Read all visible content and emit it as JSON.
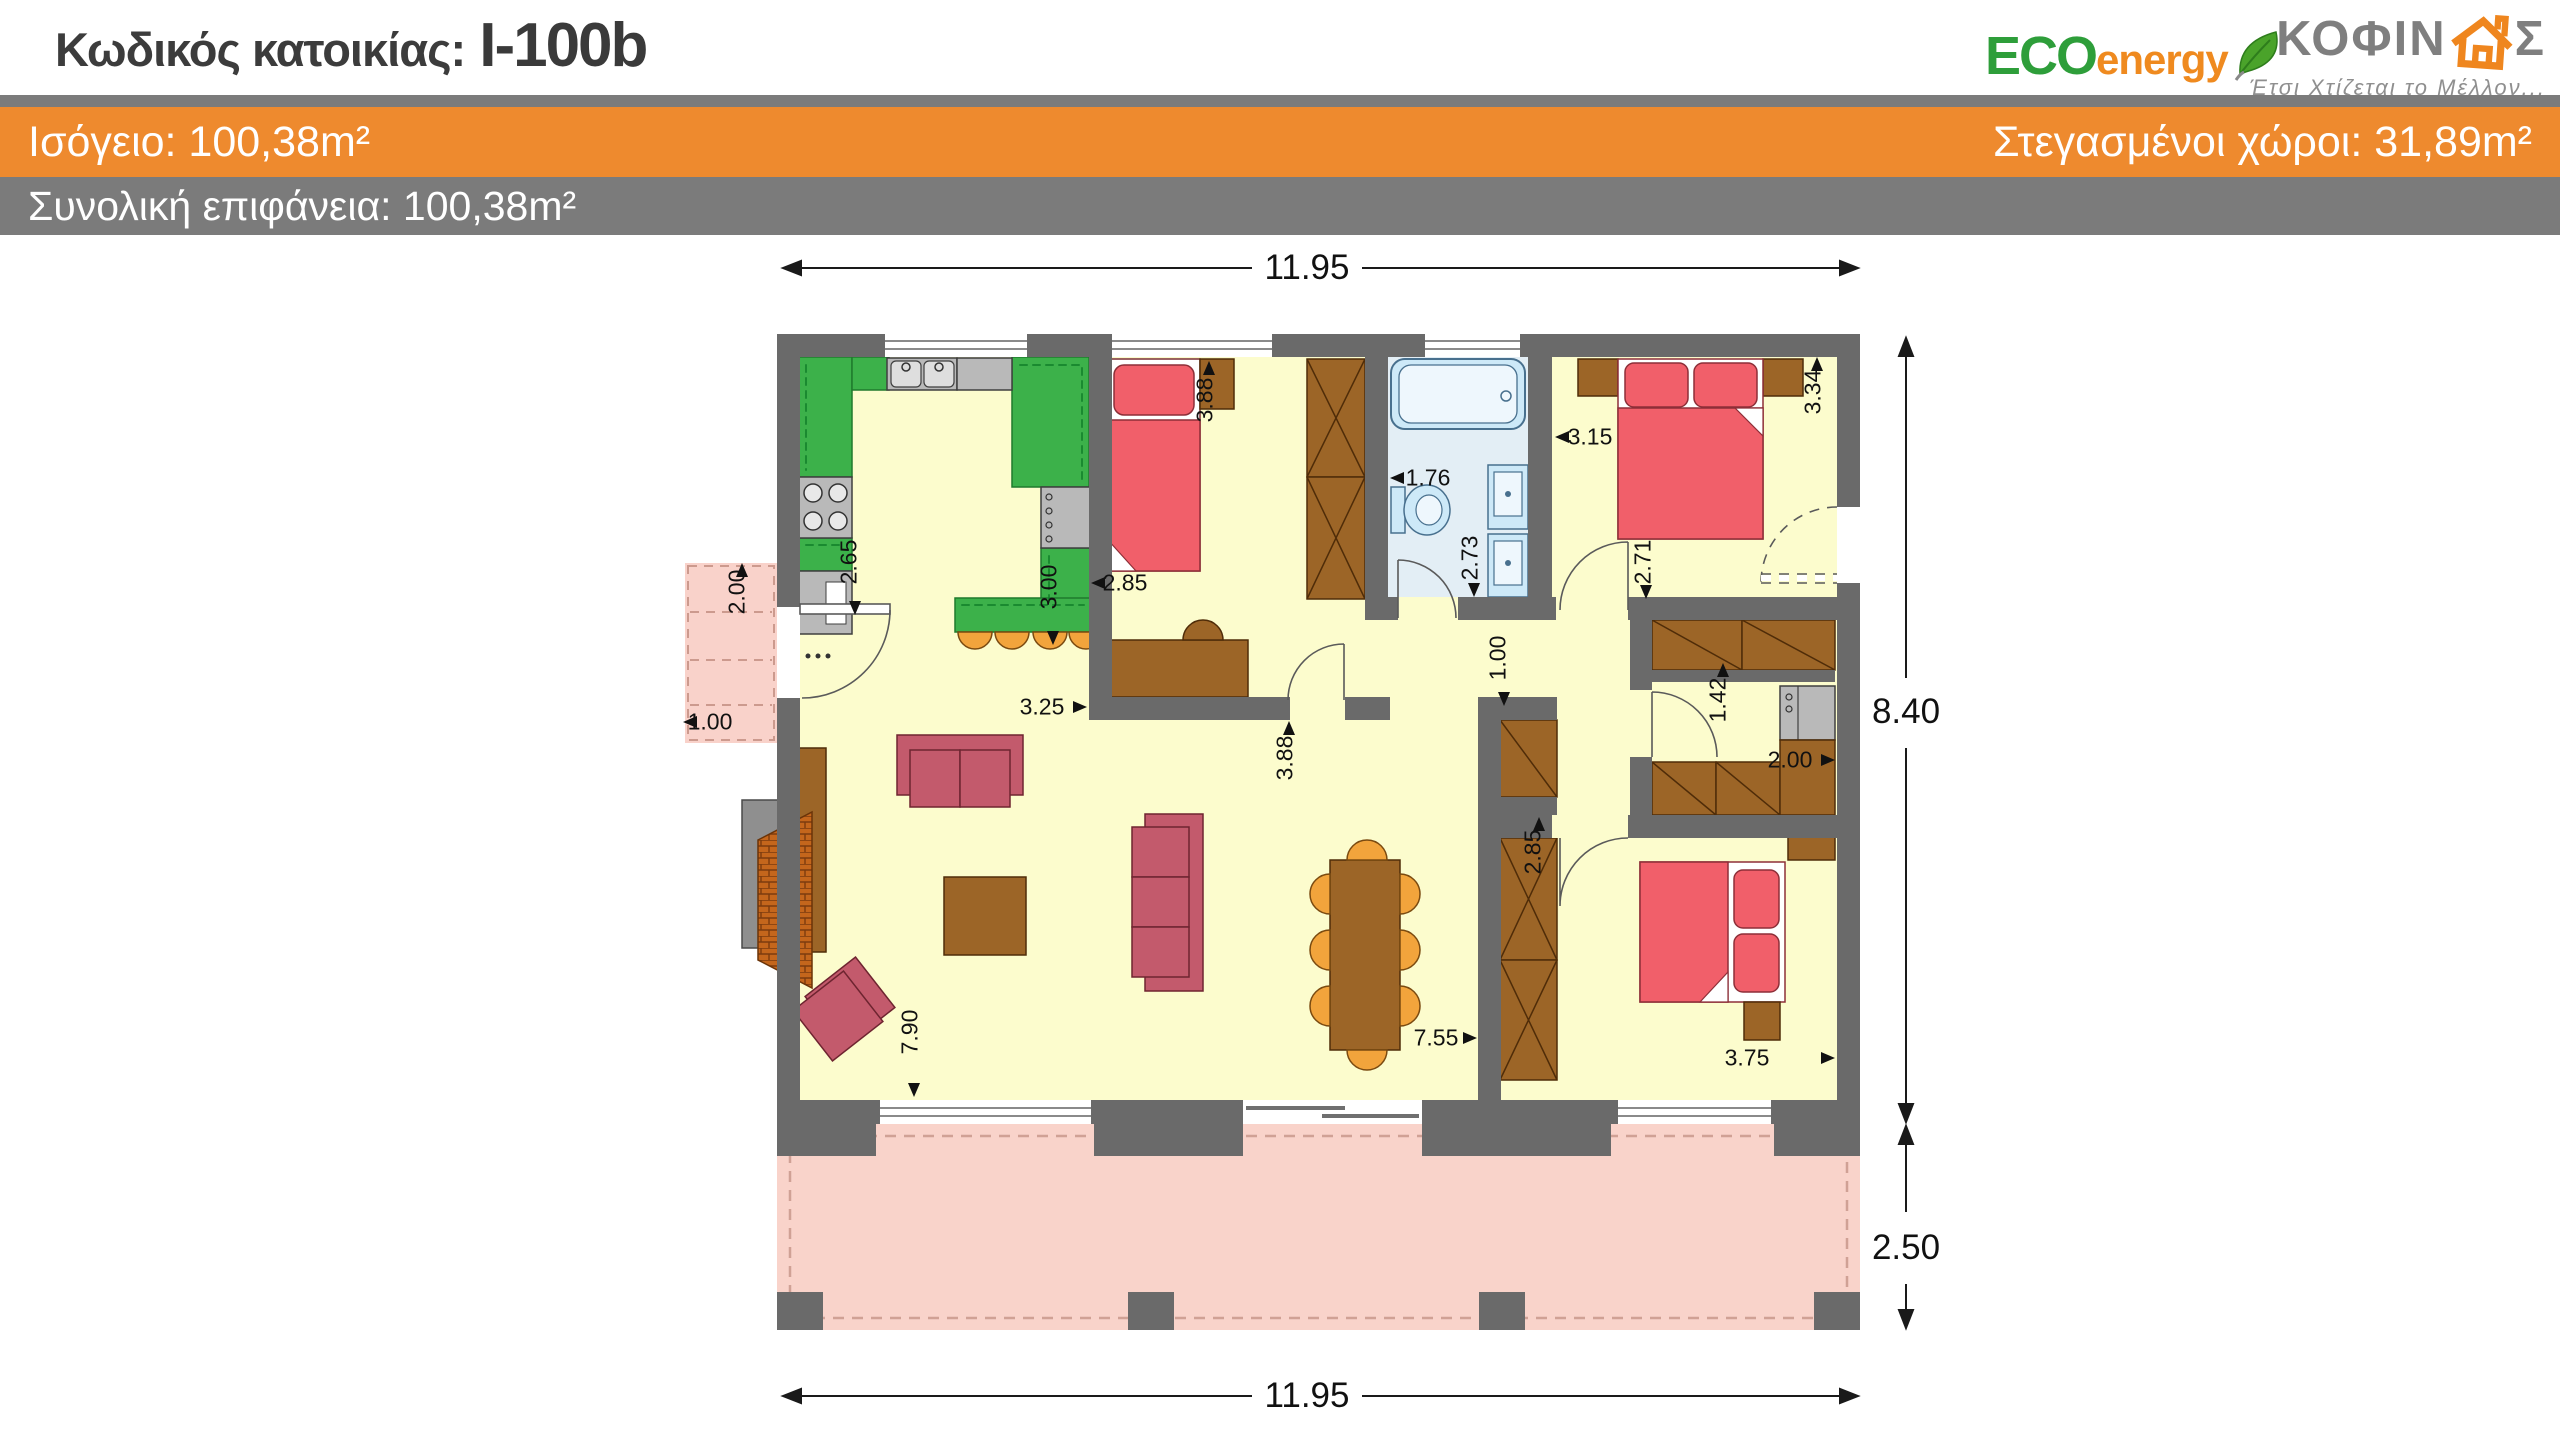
{
  "header": {
    "code_label": "Κωδικός κατοικίας:",
    "code_value": "I-100b",
    "floor_area_label": "Ισόγειο: 100,38m²",
    "covered_area_label": "Στεγασμένοι χώροι: 31,89m²",
    "total_area_label": "Συνολική επιφάνεια: 100,38m²",
    "colors": {
      "accent_orange": "#EE8A2E",
      "band_gray": "#7B7B7B"
    }
  },
  "logos": {
    "eco_energy": {
      "eco": "ECO",
      "energy": "energy",
      "leaf_icon": "leaf-icon"
    },
    "kofinas": {
      "letters_pre": "ΚΟΦΙΝ",
      "house_icon": "house-icon",
      "letters_post": "Σ",
      "tagline": "Έτσι Χτίζεται το Μέλλον..."
    }
  },
  "plan": {
    "overall": {
      "width_m": "11.95",
      "house_depth_m": "8.40",
      "terrace_depth_m": "2.50"
    },
    "dimensions": [
      {
        "id": "top-width",
        "text": "11.95",
        "x": 1307,
        "y": 268,
        "rot": 0,
        "big": true,
        "arrow": null
      },
      {
        "id": "bottom-width",
        "text": "11.95",
        "x": 1307,
        "y": 1396,
        "rot": 0,
        "big": true,
        "arrow": null
      },
      {
        "id": "house-depth",
        "text": "8.40",
        "x": 1906,
        "y": 712,
        "rot": 0,
        "big": true,
        "arrow": null
      },
      {
        "id": "terrace-depth",
        "text": "2.50",
        "x": 1906,
        "y": 1248,
        "rot": 0,
        "big": true,
        "arrow": null
      },
      {
        "id": "porch-width",
        "text": "2.00",
        "x": 737,
        "y": 592,
        "rot": -90,
        "big": false,
        "arrow": {
          "x": 742,
          "y": 570,
          "dir": "up"
        }
      },
      {
        "id": "porch-depth",
        "text": "1.00",
        "x": 710,
        "y": 722,
        "rot": 0,
        "big": false,
        "arrow": {
          "x": 690,
          "y": 722,
          "dir": "left"
        }
      },
      {
        "id": "kitchen-depth",
        "text": "2.65",
        "x": 849,
        "y": 562,
        "rot": -90,
        "big": false,
        "arrow": {
          "x": 855,
          "y": 608,
          "dir": "down"
        }
      },
      {
        "id": "kitchen-width",
        "text": "3.00",
        "x": 1049,
        "y": 587,
        "rot": -90,
        "big": false,
        "arrow": {
          "x": 1053,
          "y": 638,
          "dir": "down"
        }
      },
      {
        "id": "bed1-width",
        "text": "2.85",
        "x": 1125,
        "y": 583,
        "rot": 0,
        "big": false,
        "arrow": {
          "x": 1098,
          "y": 583,
          "dir": "left"
        }
      },
      {
        "id": "bed1-depth",
        "text": "3.88",
        "x": 1205,
        "y": 400,
        "rot": -90,
        "big": false,
        "arrow": {
          "x": 1209,
          "y": 368,
          "dir": "up"
        }
      },
      {
        "id": "living-open",
        "text": "3.25",
        "x": 1042,
        "y": 707,
        "rot": 0,
        "big": false,
        "arrow": {
          "x": 1080,
          "y": 707,
          "dir": "right"
        }
      },
      {
        "id": "living-depth",
        "text": "3.88",
        "x": 1285,
        "y": 758,
        "rot": -90,
        "big": false,
        "arrow": {
          "x": 1289,
          "y": 728,
          "dir": "up"
        }
      },
      {
        "id": "bath-width",
        "text": "1.76",
        "x": 1428,
        "y": 478,
        "rot": 0,
        "big": false,
        "arrow": {
          "x": 1397,
          "y": 478,
          "dir": "left"
        }
      },
      {
        "id": "bath-depth",
        "text": "2.73",
        "x": 1470,
        "y": 558,
        "rot": -90,
        "big": false,
        "arrow": {
          "x": 1474,
          "y": 590,
          "dir": "down"
        }
      },
      {
        "id": "master-width",
        "text": "3.15",
        "x": 1590,
        "y": 437,
        "rot": 0,
        "big": false,
        "arrow": {
          "x": 1562,
          "y": 437,
          "dir": "left"
        }
      },
      {
        "id": "master-depth",
        "text": "3.34",
        "x": 1813,
        "y": 392,
        "rot": -90,
        "big": false,
        "arrow": {
          "x": 1817,
          "y": 364,
          "dir": "up"
        }
      },
      {
        "id": "master-lower",
        "text": "2.71",
        "x": 1643,
        "y": 562,
        "rot": -90,
        "big": false,
        "arrow": {
          "x": 1646,
          "y": 592,
          "dir": "down"
        }
      },
      {
        "id": "hall-width",
        "text": "1.00",
        "x": 1498,
        "y": 658,
        "rot": -90,
        "big": false,
        "arrow": {
          "x": 1504,
          "y": 699,
          "dir": "down"
        }
      },
      {
        "id": "closet-door",
        "text": "1.42",
        "x": 1718,
        "y": 700,
        "rot": -90,
        "big": false,
        "arrow": {
          "x": 1723,
          "y": 670,
          "dir": "up"
        }
      },
      {
        "id": "closet-depth",
        "text": "2.00",
        "x": 1790,
        "y": 760,
        "rot": 0,
        "big": false,
        "arrow": {
          "x": 1828,
          "y": 760,
          "dir": "right"
        }
      },
      {
        "id": "bed2-depth",
        "text": "2.85",
        "x": 1533,
        "y": 852,
        "rot": -90,
        "big": false,
        "arrow": {
          "x": 1539,
          "y": 824,
          "dir": "up"
        }
      },
      {
        "id": "living-length",
        "text": "7.90",
        "x": 910,
        "y": 1032,
        "rot": -90,
        "big": false,
        "arrow": {
          "x": 914,
          "y": 1090,
          "dir": "down"
        }
      },
      {
        "id": "living-to-bed2",
        "text": "7.55",
        "x": 1436,
        "y": 1038,
        "rot": 0,
        "big": false,
        "arrow": {
          "x": 1470,
          "y": 1038,
          "dir": "right"
        }
      },
      {
        "id": "bed2-width",
        "text": "3.75",
        "x": 1747,
        "y": 1058,
        "rot": 0,
        "big": false,
        "arrow": {
          "x": 1828,
          "y": 1058,
          "dir": "right"
        }
      }
    ]
  }
}
